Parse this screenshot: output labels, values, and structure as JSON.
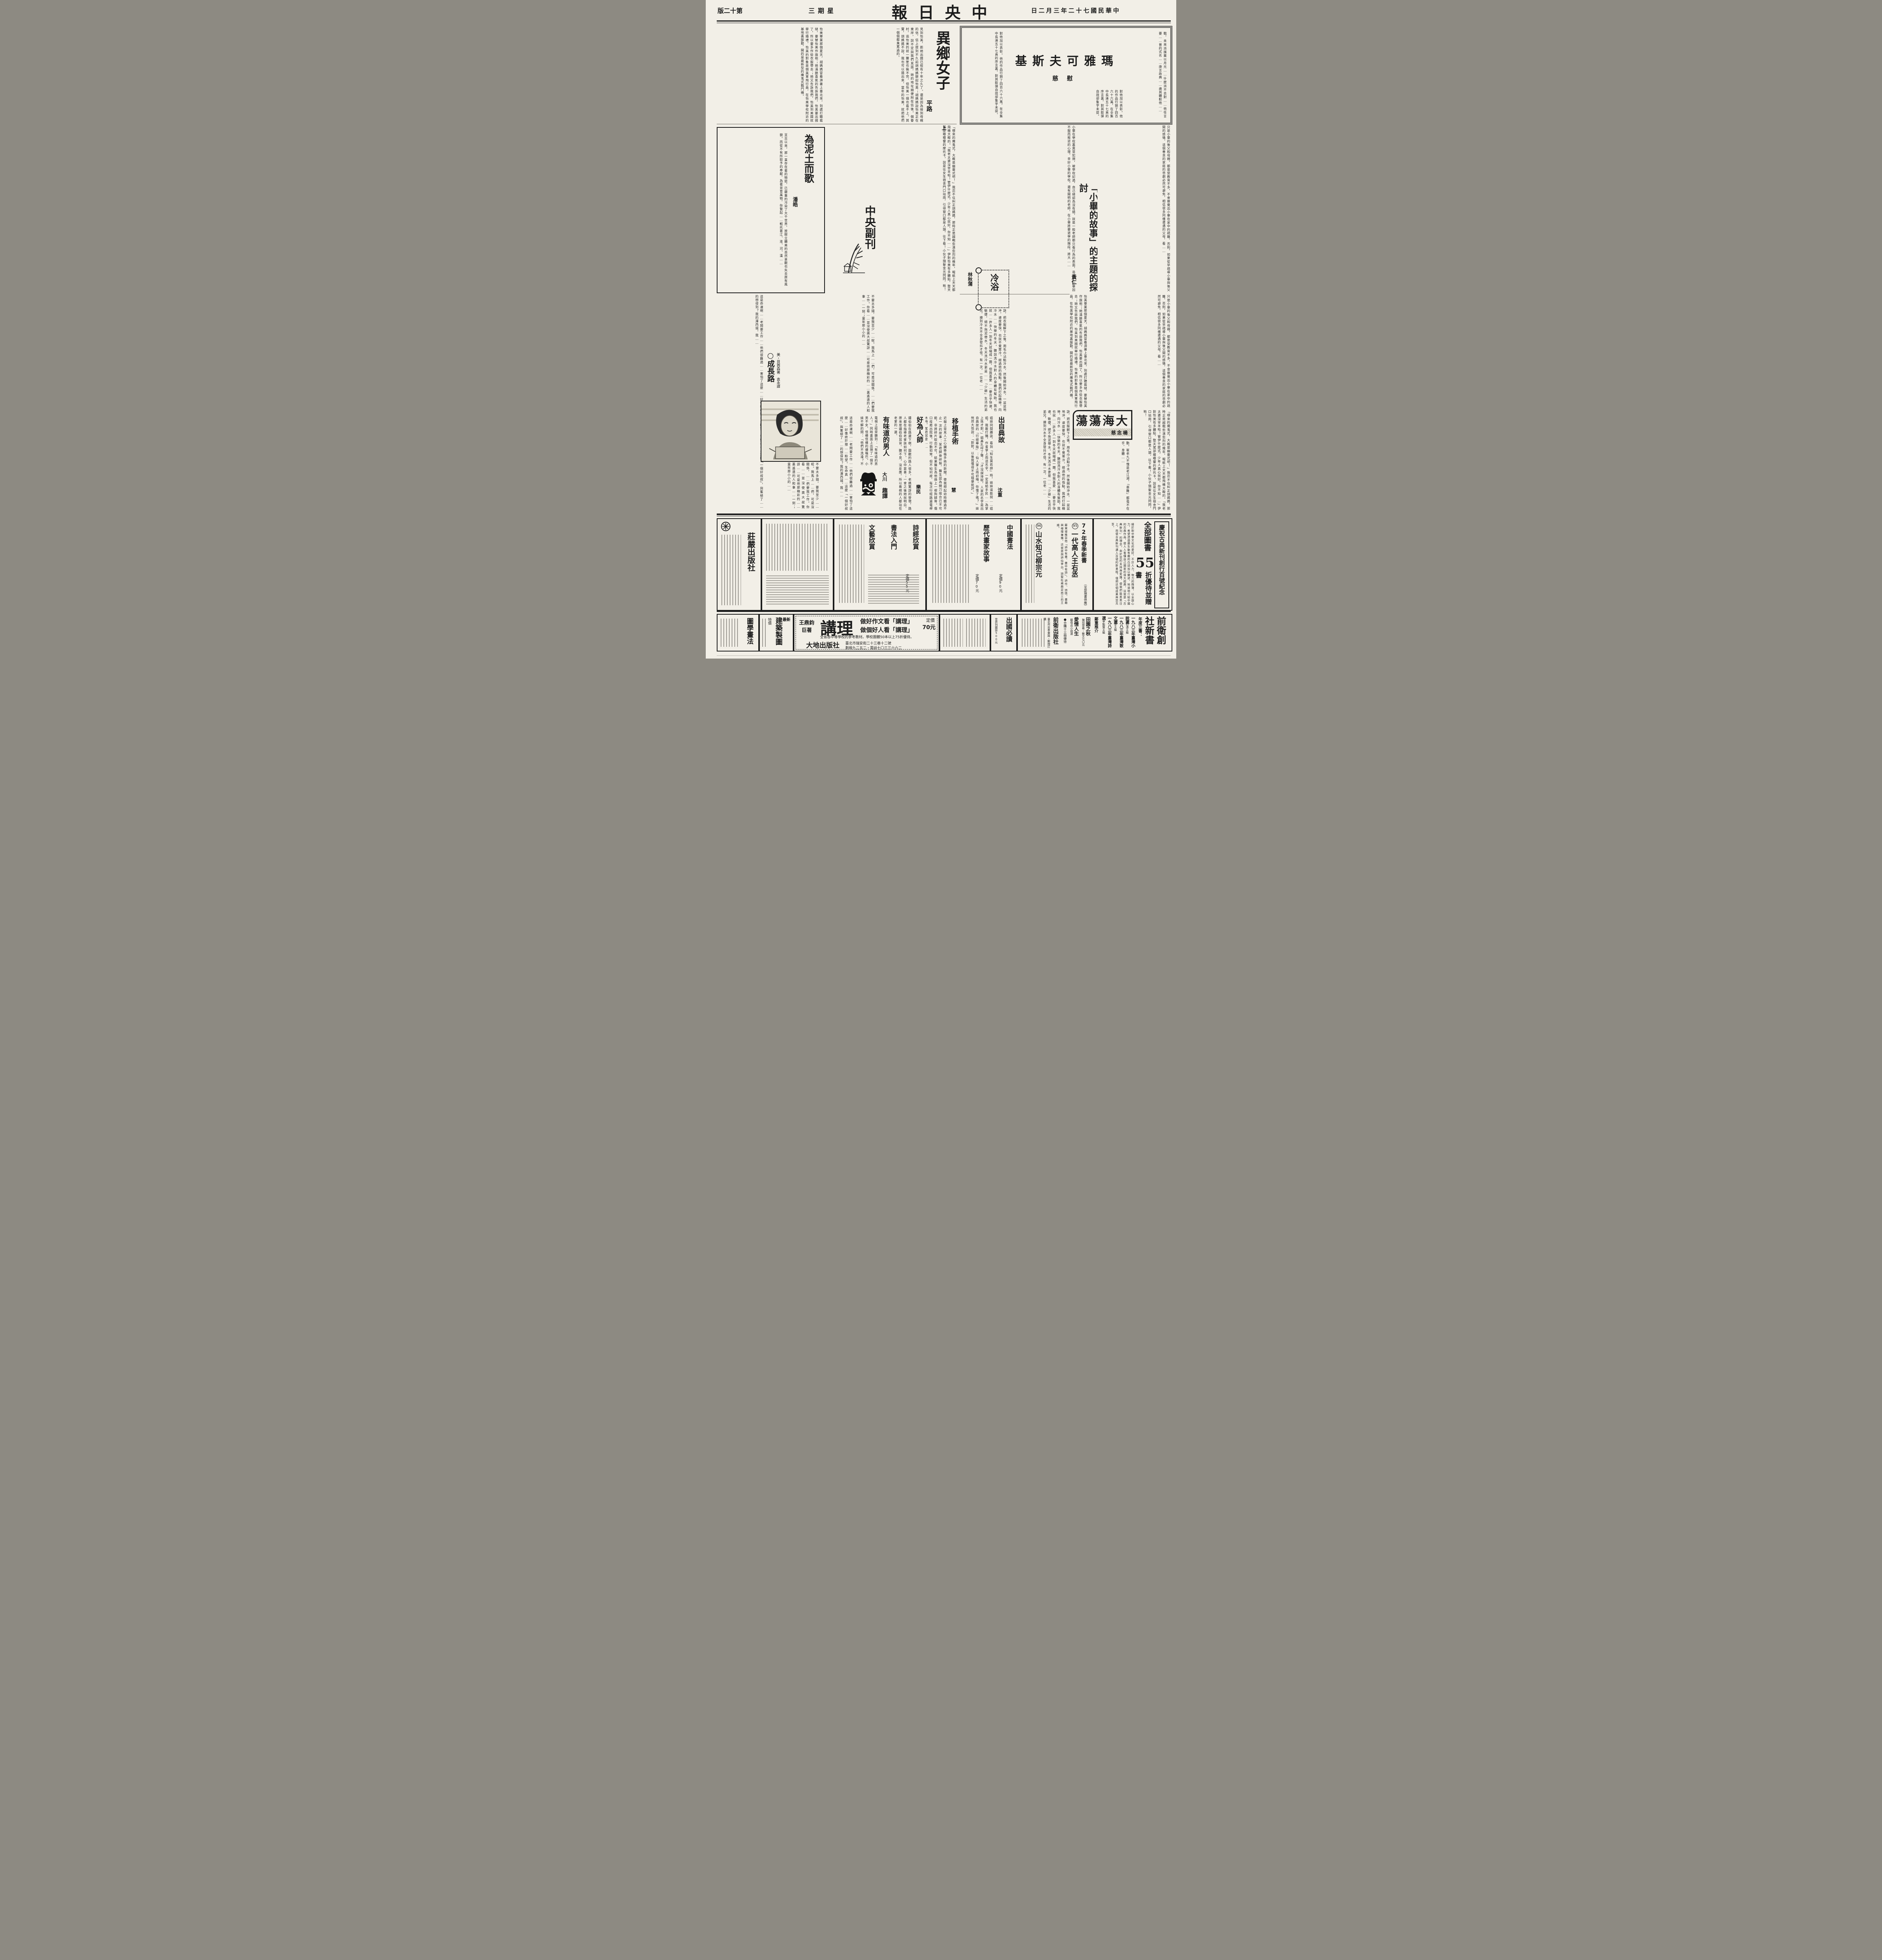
{
  "colors": {
    "paper": "#f2efe7",
    "ink": "#1c1c1c"
  },
  "masthead": {
    "title": "中央日報",
    "page": "第十二版",
    "weekday": "星期三",
    "date": "中華民國七十二年三月二日"
  },
  "maya": {
    "title": "瑪雅可夫斯基",
    "author": "慰慈",
    "body1": "戰，未來派擯棄以月光……什麼派不去對……他任言要……普的式名……庚言政典……歲其體較他……",
    "body2": "對他加以表彰。他的作品行銷了四百六十六萬，在全集中長達五十七頁的序言裏，對其飲彈自戕卻隻字未提。"
  },
  "stranger": {
    "title": "異鄉女子",
    "part": "上",
    "author": "平路",
    "body1": "見到怡美，距她出國已經有十年之久了。還是因為接到母親的信，信上提到不久前胡媽媽聊起怡美；胡媽媽說怡美正在東岸，說不定與我們見面，她的地址順便附在信後。個眷村，追怡美的就一籮筐也裝不完，但怡美一個也看不上。其實，胡媽媽不說，我也可以猜出來，當年的怡美，就把他們一個個都臭罵過的。",
    "body2": "怡美畢業那個夏天，胡媽媽冒着溽暑上臺北來，到處打聽裁縫，要替怡美作旗袍；她滿臉喜氣的告訴我們，怡美要出國了，所以要多作些衣服帶去；她又告訴我們，怡美到美國就舉行婚禮，怡美的對象是個美軍飛行員，在怡美學校附近的基地裏服勤，開的是最新型的魔鬼式戰鬥機。",
    "body3": "「哪來的魔鬼式，大概是幽靈式吧！」我忍不住糾正胡媽媽，那時正是越戰愈演愈烈的幾年，報紙上天天都飛機大礮的。「我老太婆沒宰羊啦！管伊什麼式，少年人真心就好，你不知……」伊對怡美有多體貼，整天駕部嘟嘟響的摩托卡，說是往女生宿舍門口站崗，引得窗口都是人頭，往下看！小伙子頭髮金光閃閃，喲！"
  },
  "soil": {
    "title": "為泥土而歌",
    "author": "潘皓",
    "body": "亘古以來，那一直存在著的物慾，已嚴重的污染了大千世界，放眼立體美的自然景觀也失去原有風貌。而從不有所取予的奉獻，為著並育萬物，你繫起……輕托著江、淮、河、漢……"
  },
  "supplement": {
    "name": "中央副刊"
  },
  "xiaobi": {
    "title": "「小畢的故事」的主題的探討",
    "author": "黃仁",
    "body1": "小畢在學校裏異常犯規，被學校記過，自己總認為沒有錯，就是一般老師都只看行為的表面，造成了小畢因不服而叛逆的心理，幸好小畢的學校，還有開明的老師，在小畢將要退學的階段，將大……",
    "body2": "只是小畢的後父和母親，都是受教育不多，不會察覺出小畢在家中的疏離，否則，如果從早疏導小畢與後父間的感情，這個善良的家庭的悲劇必然可避免，相信很多同樣遭遇的父母，看……"
  },
  "cold": {
    "title": "冷浴",
    "author": "林秋蒲",
    "body": "訣，把衣服解下之後，用毛巾沾點冷水，然後開始沖水，一盆盆地沖，速度要快，也就不覺寒冷。經過他的指點，我們打起精神，向冷水……快樂的冬天。聽說洗冷水對人的身體有幫助，我也就……許多人一到冬天就縮成一團，但我喜愛……要合乎快速、敏捷，絕不拖泥帶水。冬天洗冷水更是……「少爺」生活的弟兄，摸到冷水不全身發抖才怪，有一次，一位老……"
  },
  "grow": {
    "title": "○成長路",
    "credit": "美・貝茜森著　袁永譯",
    "body1": "這是命運啊……老闆要工作……他們很難過……害怕了這麼……好像終於撥……盼望。生命真……這麼「一個好叔叔」，與奮極了……的想得到？我的澤西城。我……",
    "body2": "不要太多錢，要我至少……呢。我馬上……們，可是沒關係，……們要我工作。你看……並沒使奧大叔驚訝……可是他那精彩的……裏遙遠的人和事……一刻；童年那小小的……"
  },
  "sea": {
    "title": "大海蕩蕩",
    "author": "楊念慈",
    "body": "動。崔老九不愧是老江湖，「患難」都毫不在乎，身體……"
  },
  "humor": {
    "section": "趣譚",
    "dian": {
      "title": "出自典故",
      "author": "沈重",
      "body": "姐妹同閱趣談，看到「知生莫若師」時，妹妹逞能說……姐姐，我敢打賭，作者掌上雨這名字，一定是給手民……為掌上珠才對。」姐鼻孔哼了聲：「才沒誤排呢，人家的名字是出自典故的『行經華陰』：仙人掌上雨初晴。你懂了嗎？」妹恍然大悟說：「對對，以後我懂得不可隨便批評。」"
    },
    "yizhi": {
      "title": "移植手術",
      "author": "慧",
      "body": "近報上常見人工心臟移植手術的新聞，使我想起幼時聽過不止一次的故事：某君腿骨碎裂，醫生認為開刀接合已不可能，非將碎片取出不可，結果醫生為他換上一根狗腿骨。傷口痊癒出院後，行動如常，但不知何故，每次行經路邊電桿木時，某君就會……"
    },
    "hao": {
      "title": "好為人師",
      "author": "樂民",
      "body": "鍾伯伯在路邊下棋，圍觀的路人很多，老媽驚訝的發現，路人都在指導老爹該如何下，心中甚喜；一會之後她就明白，原來是鍾伯伯耳背，聽不見，沒反應，所以看棋的人都站在老爹的一邊。"
    },
    "wei": {
      "title": "有味道的男人",
      "author": "大川",
      "body": "電視上經常聽到：「有味道的男人！」同時畫面上出現了一個不男不女、怪模怪樣的擤嘴巴。小妹不解的問：「他們不洗澡？不然為什麼會有味道？」"
    }
  },
  "ads": {
    "zhuangyan": {
      "name": "莊嚴出版社"
    },
    "center": {
      "items": [
        {
          "t": "詩經欣賞",
          "p": "定價55元"
        },
        {
          "t": "書法入門",
          "p": ""
        },
        {
          "t": "文藝欣賞",
          "p": ""
        },
        {
          "t": "中國書法",
          "p": "定價90元"
        },
        {
          "t": "歷代畫家故事",
          "p": "定價70元"
        }
      ]
    },
    "spring": {
      "heading": "72年春季新書",
      "sub": "（全部現書供應）",
      "no1": "95",
      "item1": "一代高人王右丞",
      "no2": "96",
      "item2": "山水知己柳宗元",
      "blurb": "蘇東坡推崇他「詩中有畫，畫中有詩」，詩作、詩情、畫趣與禪理兼備，這就是與詩仙李白、詩聖杜甫鼎足而三的王維。"
    },
    "classic": {
      "heading": "慶祝古典新刊創行百號紀念",
      "offer_top": "全部圖書",
      "big": "55",
      "offer_bottom": "折優待並贈書",
      "blurb": "緣於對中華文化的愛好，不計人力、物力的微薄，以全副心力，希望透過最生動有趣的白話加以闡述，地道地介紹中國的古典作品，使人人看懂自己國家的偉大經典，這就是「古典新刊」的理念。由於您的支持與愛護，使我們能蒸蒸日上，而使古典新刊邁入百號的新里程，僅把這個成果與您共享。"
    },
    "lecture": {
      "brand1": "王鼎鈞",
      "brand2": "巨著",
      "product": "講理",
      "slogan1": "做好作文看「講理」",
      "slogan2": "做個好人看「講理」",
      "price1": "定價",
      "price2": "70元",
      "note": "全省各中等學校的參考教材。學校團體50本以上75折優待。",
      "publisher": "大地出版社",
      "address": "臺北市瑞安街二十三巷十二號",
      "contact": "劃撥九二五二・電話七〇三三六六二"
    },
    "drafting": {
      "tag": "最新",
      "title": "建築製圖",
      "note": "特價"
    },
    "tuxue": {
      "title": "圖學畫法"
    },
    "abroad": {
      "title": "出國必讀",
      "sub": "世界列國誌500元"
    },
    "qianwei": {
      "h1": "前衛創",
      "h2": "社新書",
      "series": "年度三書：",
      "b1": "一九八三年臺灣小說選",
      "e1": "葉石濤主編",
      "b2": "一九八三年臺灣散文選",
      "e2": "季季主編",
      "b3": "一九八三年臺灣詩選",
      "e3": "李魁賢主編",
      "promo": "鄭重推介",
      "p1": "田園之秋",
      "pa1": "陳冠學著・散文七〇元",
      "p2": "愛情人生",
      "pa2": "蘇偉貞小說選",
      "bundle": "●合購十三冊優待",
      "publisher": "前衛出版社",
      "contact": "臺北市忠孝東路・郵撥訂購"
    }
  }
}
